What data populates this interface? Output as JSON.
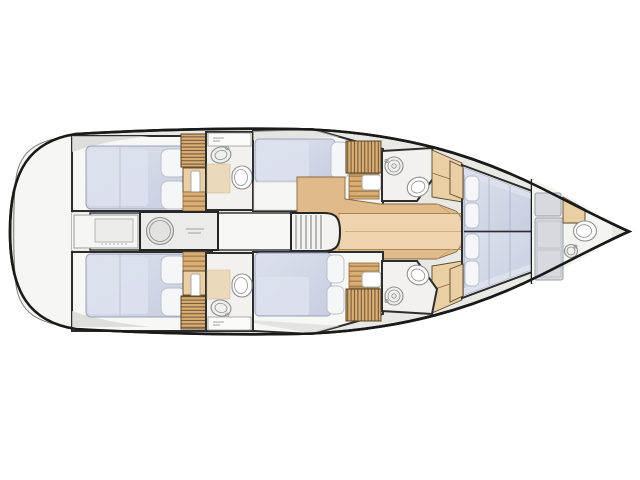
{
  "diagram": {
    "kind": "yacht-interior-floorplan",
    "orientation": "bow-right"
  },
  "fixtures": {
    "bed": "double-berth",
    "pillow": "pillow",
    "toilet": "toilet-icon",
    "sink": "sink-icon",
    "grating": "wood-slat-grating",
    "steps": "companion-steps",
    "washer": "washing-machine-icon",
    "companionway": "stairs-icon",
    "locker": "storage-locker"
  },
  "colors": {
    "background": "#ffffff",
    "hull_outline": "#1a1a1a",
    "deck_gray": "#e8e9e5",
    "deck_shadow": "#d7d8d4",
    "wall_dark": "#2d2d2d",
    "room_white": "#f7f7f4",
    "bathroom_white": "#f2f1ee",
    "bed_base": "#c8cedf",
    "bed_light": "#dde1ee",
    "bed_edge": "#9aa2bb",
    "pillow": "#f5f6f8",
    "pillow_edge": "#b9bdc9",
    "wood_floor": "#e0ba8b",
    "wood_light": "#efd6af",
    "wood_step": "#d8ae74",
    "slat_line": "#6f5130",
    "cabinet_tan": "#e9cfa3",
    "fixture_outline": "#8f8f8f",
    "fixture_fill": "#ffffff",
    "appliance_fill": "#ebebe9",
    "gray_furniture": "#d6d9dd",
    "shower_tan": "#ead9ba",
    "stern_panel": "#f6f6f3"
  }
}
